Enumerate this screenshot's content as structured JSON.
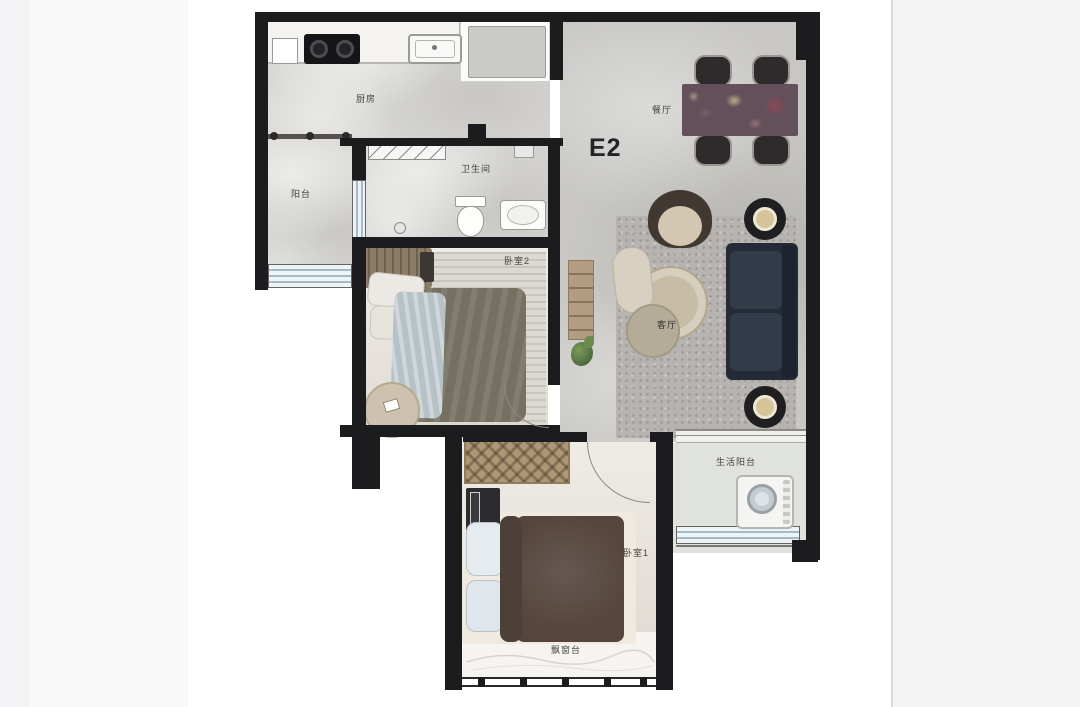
{
  "plan": {
    "unit_label": "E2",
    "rooms": {
      "kitchen": {
        "label": "厨房"
      },
      "balcony": {
        "label": "阳台"
      },
      "bathroom": {
        "label": "卫生间"
      },
      "bedroom2": {
        "label": "卧室2"
      },
      "dining": {
        "label": "餐厅"
      },
      "living": {
        "label": "客厅"
      },
      "utility_balcony": {
        "label": "生活阳台"
      },
      "bedroom1": {
        "label": "卧室1"
      },
      "bay_window": {
        "label": "飘窗台"
      }
    },
    "colors": {
      "wall": "#1c1c1e",
      "floor_hard": "#d7d6d3",
      "floor_living": "#c8c7c4",
      "floor_bedroom": "#eae5dd",
      "floor_utility": "#e0e2de",
      "rug_living": "#b7b3b0",
      "sofa": "#242b36",
      "duvet_bedroom2": "#767062",
      "duvet_bedroom1": "#55453d",
      "dining_table": "#63505a",
      "window_glass": "#a3bcc7",
      "page_band": "#f3f3f5",
      "label_text": "#44443f"
    }
  }
}
